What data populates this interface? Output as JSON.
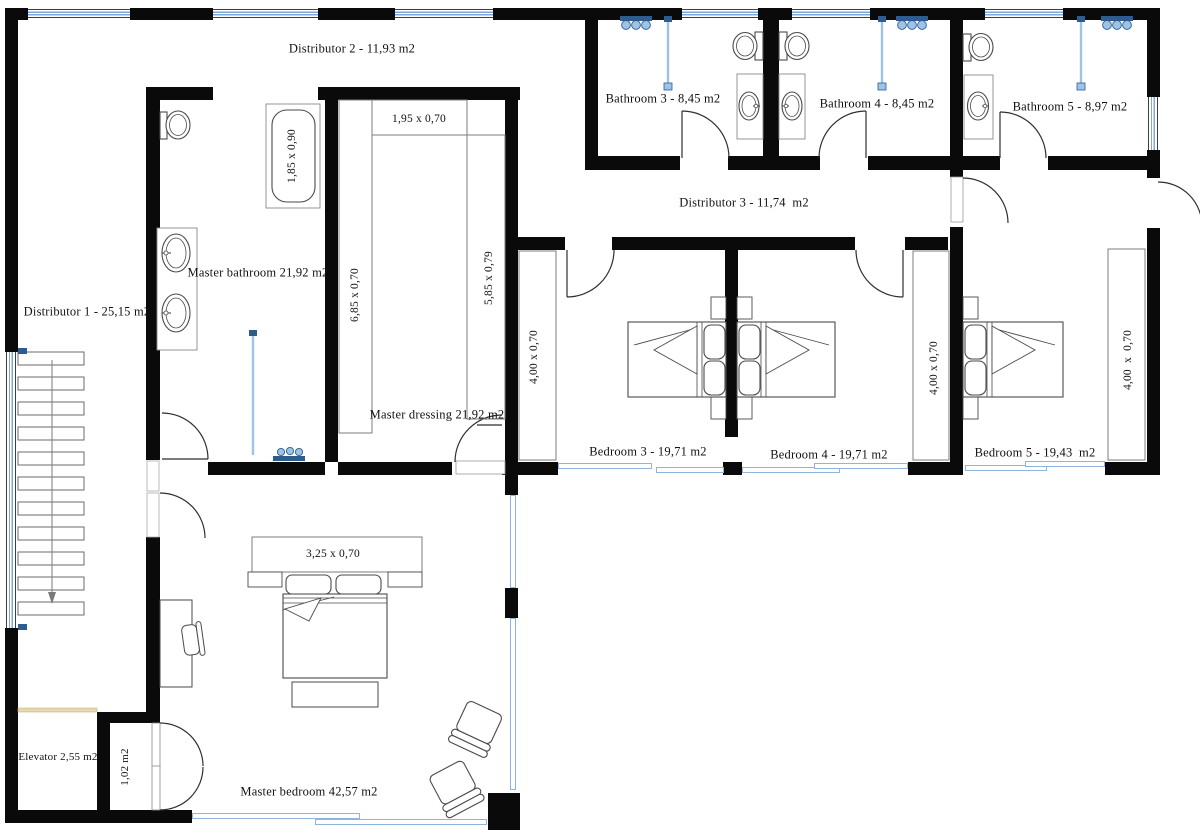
{
  "rooms": {
    "distributor1": {
      "label": "Distributor 1 - 25,15 m2"
    },
    "distributor2": {
      "label": "Distributor 2 - 11,93 m2"
    },
    "distributor3": {
      "label": "Distributor 3 - 11,74  m2"
    },
    "bathroom3": {
      "label": "Bathroom 3 - 8,45 m2"
    },
    "bathroom4": {
      "label": "Bathroom 4 - 8,45 m2"
    },
    "bathroom5": {
      "label": "Bathroom 5 - 8,97 m2"
    },
    "master_bathroom": {
      "label": "Master bathroom 21,92 m2"
    },
    "master_dressing": {
      "label": "Master dressing 21,92 m2"
    },
    "master_bedroom": {
      "label": "Master bedroom 42,57 m2"
    },
    "bedroom3": {
      "label": "Bedroom 3 - 19,71 m2"
    },
    "bedroom4": {
      "label": "Bedroom 4 - 19,71 m2"
    },
    "bedroom5": {
      "label": "Bedroom 5 - 19,43  m2"
    },
    "elevator": {
      "label": "Elevator 2,55 m2"
    },
    "hall_small": {
      "label": "1,02 m2"
    }
  },
  "dimensions": {
    "bathtub": "1,85 x 0,90",
    "dressing_top_closet": "1,95 x 0,70",
    "dressing_left_closet": "6,85 x 0,70",
    "dressing_right_closet": "5,85 x 0,79",
    "master_bed_closet": "3,25 x 0,70",
    "bedroom3_closet": "4,00 x 0,70",
    "bedroom4_closet": "4,00 x 0,70",
    "bedroom5_closet": "4,00  x  0,70"
  },
  "colors": {
    "wall": "#0a0a0a",
    "window_blue": "#7fa8d9",
    "fixture_blue_light": "#9dc3e6",
    "fixture_blue_dark": "#2e5c8f",
    "elevator_door_tan": "#e6d7ac",
    "furniture_outline": "#4a4a4a"
  }
}
